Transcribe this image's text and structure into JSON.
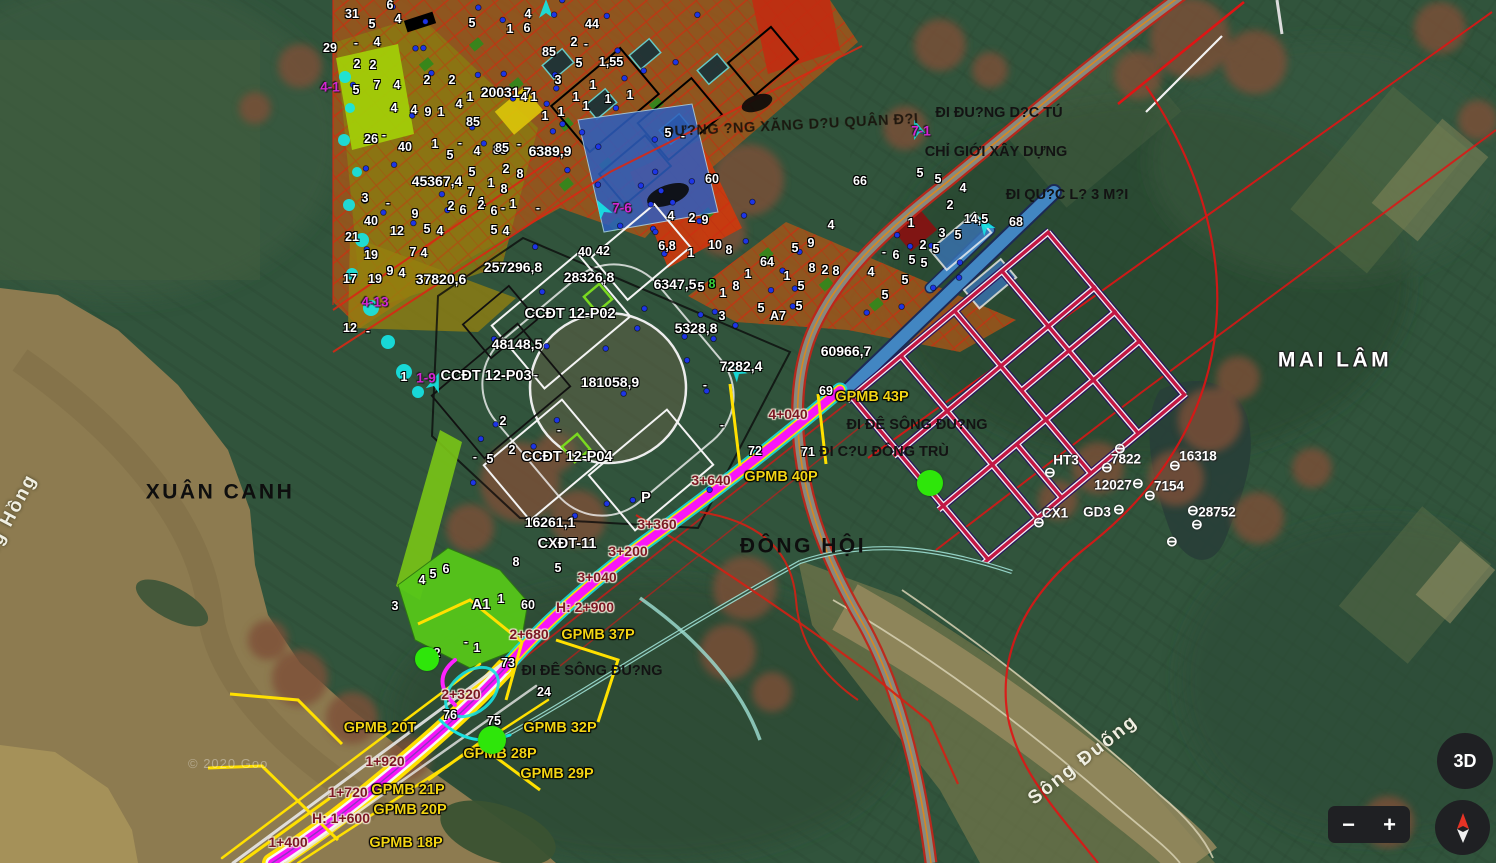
{
  "map": {
    "watermark": "© 2020 Goo",
    "place_labels": [
      {
        "text": "XUÂN CANH",
        "x": 220,
        "y": 492
      },
      {
        "text": "ĐÔNG HỘI",
        "x": 803,
        "y": 546
      },
      {
        "text": "MAI LÂM",
        "x": 1335,
        "y": 360,
        "variant": "halo"
      },
      {
        "text": "Sông Đuống",
        "x": 1083,
        "y": 760,
        "rotate": -38,
        "variant": "water"
      },
      {
        "text": "Sông Hồng",
        "x": 4,
        "y": 528,
        "rotate": -62,
        "variant": "water"
      }
    ],
    "road_labels": [
      {
        "text": "ĐI ĐU?NG D?C TÚ",
        "x": 999,
        "y": 113
      },
      {
        "text": "CHỈ GIỚI XÂY DỰNG",
        "x": 996,
        "y": 152
      },
      {
        "text": "ĐI QU?C L? 3 M?I",
        "x": 1067,
        "y": 195
      },
      {
        "text": "ĐƯ?NG ?NG XĂNG D?U QUÂN Đ?I",
        "x": 791,
        "y": 126,
        "rotate": -3,
        "variant": "pipeline"
      },
      {
        "text": "ĐI ĐÊ SÔNG ĐU?NG",
        "x": 917,
        "y": 425
      },
      {
        "text": "ĐI C?U ĐÔNG TRÙ",
        "x": 884,
        "y": 452
      },
      {
        "text": "ĐI ĐÊ SÔNG ĐU?NG",
        "x": 592,
        "y": 671
      }
    ],
    "area_labels": [
      {
        "text": "20031,7",
        "x": 506,
        "y": 92
      },
      {
        "text": "6389,9",
        "x": 550,
        "y": 151
      },
      {
        "text": "45367,4",
        "x": 437,
        "y": 181
      },
      {
        "text": "257296,8",
        "x": 513,
        "y": 267
      },
      {
        "text": "37820,6",
        "x": 441,
        "y": 279
      },
      {
        "text": "28326,8",
        "x": 589,
        "y": 277
      },
      {
        "text": "6347,5",
        "x": 675,
        "y": 284
      },
      {
        "text": "5328,8",
        "x": 696,
        "y": 328
      },
      {
        "text": "48148,5",
        "x": 517,
        "y": 344
      },
      {
        "text": "181058,9",
        "x": 610,
        "y": 382
      },
      {
        "text": "7282,4",
        "x": 741,
        "y": 366
      },
      {
        "text": "60966,7",
        "x": 846,
        "y": 351
      },
      {
        "text": "16261,1",
        "x": 550,
        "y": 522
      }
    ],
    "zone_labels": [
      {
        "text": "CCĐT 12-P02",
        "x": 570,
        "y": 314
      },
      {
        "text": "CCĐT 12-P03",
        "x": 486,
        "y": 376
      },
      {
        "text": "CCĐT 12-P04",
        "x": 567,
        "y": 457
      },
      {
        "text": "CXĐT-11",
        "x": 567,
        "y": 544
      },
      {
        "text": "A1",
        "x": 481,
        "y": 605
      },
      {
        "text": "P",
        "x": 646,
        "y": 498
      }
    ],
    "gpmb_labels": [
      {
        "text": "GPMB 43P",
        "x": 872,
        "y": 397
      },
      {
        "text": "GPMB 40P",
        "x": 781,
        "y": 477
      },
      {
        "text": "GPMB 37P",
        "x": 598,
        "y": 635
      },
      {
        "text": "GPMB 32P",
        "x": 560,
        "y": 728
      },
      {
        "text": "GPMB 28P",
        "x": 500,
        "y": 754
      },
      {
        "text": "GPMB 29P",
        "x": 557,
        "y": 774
      },
      {
        "text": "GPMB 20T",
        "x": 380,
        "y": 728
      },
      {
        "text": "GPMB 21P",
        "x": 408,
        "y": 790
      },
      {
        "text": "GPMB 20P",
        "x": 410,
        "y": 810
      },
      {
        "text": "GPMB 18P",
        "x": 406,
        "y": 843
      }
    ],
    "chainage_labels": [
      {
        "text": "4+040",
        "x": 788,
        "y": 414
      },
      {
        "text": "3+640",
        "x": 711,
        "y": 480
      },
      {
        "text": "3+360",
        "x": 657,
        "y": 524
      },
      {
        "text": "3+200",
        "x": 628,
        "y": 551
      },
      {
        "text": "3+040",
        "x": 597,
        "y": 577
      },
      {
        "text": "H: 2+900",
        "x": 585,
        "y": 607
      },
      {
        "text": "2+680",
        "x": 529,
        "y": 634
      },
      {
        "text": "2+320",
        "x": 461,
        "y": 694
      },
      {
        "text": "1+920",
        "x": 385,
        "y": 761
      },
      {
        "text": "1+720",
        "x": 348,
        "y": 792
      },
      {
        "text": "H: 1+600",
        "x": 341,
        "y": 818
      },
      {
        "text": "1+400",
        "x": 288,
        "y": 842
      }
    ],
    "route_marker_labels": [
      {
        "text": "4-1",
        "x": 330,
        "y": 87
      },
      {
        "text": "4-13",
        "x": 375,
        "y": 302
      },
      {
        "text": "1-9",
        "x": 426,
        "y": 378
      },
      {
        "text": "7-6",
        "x": 622,
        "y": 208
      },
      {
        "text": "7-1",
        "x": 921,
        "y": 131
      }
    ],
    "survey_markers": [
      {
        "text": "HT3",
        "x": 1066,
        "y": 460,
        "icon_dx": -16,
        "icon_dy": 12
      },
      {
        "text": "7822",
        "x": 1126,
        "y": 459,
        "icon_dx": -19,
        "icon_dy": 8
      },
      {
        "text": "16318",
        "x": 1198,
        "y": 456,
        "icon_dx": -23,
        "icon_dy": 9
      },
      {
        "text": "12027",
        "x": 1113,
        "y": 485,
        "icon_dx": 25,
        "icon_dy": -2
      },
      {
        "text": "7154",
        "x": 1169,
        "y": 486,
        "icon_dx": -19,
        "icon_dy": 9
      },
      {
        "text": "CX1",
        "x": 1055,
        "y": 513,
        "icon_dx": -16,
        "icon_dy": 9
      },
      {
        "text": "GD3",
        "x": 1097,
        "y": 512,
        "icon_dx": 22,
        "icon_dy": -3
      },
      {
        "text": "28752",
        "x": 1217,
        "y": 512,
        "icon_dx": -24,
        "icon_dy": -2
      }
    ],
    "extra_survey_icons": [
      [
        1120,
        448
      ],
      [
        1197,
        524
      ],
      [
        1172,
        541
      ]
    ],
    "green_dots": [
      {
        "x": 930,
        "y": 483,
        "r": 13
      },
      {
        "x": 492,
        "y": 740,
        "r": 14
      },
      {
        "x": 427,
        "y": 659,
        "r": 12
      }
    ],
    "small_numbers": [
      [
        "31",
        352,
        14
      ],
      [
        "6",
        390,
        5
      ],
      [
        "4",
        398,
        19
      ],
      [
        "5",
        372,
        24
      ],
      [
        "29",
        330,
        48
      ],
      [
        "2",
        357,
        64
      ],
      [
        "2",
        373,
        65
      ],
      [
        "4",
        377,
        42
      ],
      [
        "-",
        356,
        43
      ],
      [
        "7",
        377,
        85
      ],
      [
        "4",
        397,
        85
      ],
      [
        "5",
        356,
        90
      ],
      [
        "4",
        394,
        108
      ],
      [
        "4",
        414,
        110
      ],
      [
        "9",
        428,
        112
      ],
      [
        "1",
        441,
        112
      ],
      [
        "2",
        427,
        80
      ],
      [
        "2",
        452,
        80
      ],
      [
        "4",
        459,
        104
      ],
      [
        "1",
        470,
        97
      ],
      [
        "26",
        371,
        139
      ],
      [
        "-",
        384,
        135
      ],
      [
        "40",
        405,
        147
      ],
      [
        "1",
        435,
        144
      ],
      [
        "-",
        460,
        143
      ],
      [
        "5",
        450,
        155
      ],
      [
        "4",
        477,
        151
      ],
      [
        "85",
        500,
        150
      ],
      [
        "5",
        472,
        172
      ],
      [
        "2",
        506,
        169
      ],
      [
        "8",
        520,
        174
      ],
      [
        "7",
        471,
        192
      ],
      [
        "1",
        491,
        183
      ],
      [
        "8",
        504,
        189
      ],
      [
        "3",
        365,
        198
      ],
      [
        "-",
        388,
        203
      ],
      [
        "40",
        371,
        221
      ],
      [
        "9",
        415,
        214
      ],
      [
        "2",
        451,
        206
      ],
      [
        "6",
        463,
        210
      ],
      [
        "1",
        482,
        202
      ],
      [
        "-",
        503,
        208
      ],
      [
        "1",
        513,
        204
      ],
      [
        "21",
        352,
        237
      ],
      [
        "12",
        397,
        231
      ],
      [
        "5",
        427,
        229
      ],
      [
        "4",
        440,
        231
      ],
      [
        "19",
        371,
        255
      ],
      [
        "7",
        413,
        252
      ],
      [
        "4",
        424,
        253
      ],
      [
        "17",
        350,
        279
      ],
      [
        "19",
        375,
        279
      ],
      [
        "9",
        390,
        271
      ],
      [
        "4",
        402,
        273
      ],
      [
        "12",
        350,
        328
      ],
      [
        "-",
        368,
        331
      ],
      [
        "1",
        404,
        377
      ],
      [
        "5",
        472,
        23
      ],
      [
        "4",
        528,
        14
      ],
      [
        "1",
        510,
        29
      ],
      [
        "6",
        527,
        28
      ],
      [
        "85",
        549,
        52
      ],
      [
        "2",
        574,
        42
      ],
      [
        "-",
        586,
        44
      ],
      [
        "5",
        579,
        63
      ],
      [
        "1,55",
        611,
        62
      ],
      [
        "3",
        558,
        80
      ],
      [
        "1",
        593,
        85
      ],
      [
        "1",
        576,
        97
      ],
      [
        "1",
        608,
        99
      ],
      [
        "1",
        586,
        106
      ],
      [
        "1",
        630,
        95
      ],
      [
        "44",
        592,
        24
      ],
      [
        "85",
        473,
        122
      ],
      [
        "4",
        524,
        97
      ],
      [
        "1",
        534,
        97
      ],
      [
        "85",
        502,
        148
      ],
      [
        "-",
        519,
        144
      ],
      [
        "1",
        545,
        116
      ],
      [
        "1",
        561,
        112
      ],
      [
        "2",
        481,
        205
      ],
      [
        "6",
        494,
        211
      ],
      [
        "-",
        538,
        208
      ],
      [
        "5",
        494,
        230
      ],
      [
        "4",
        506,
        231
      ],
      [
        "5",
        668,
        133
      ],
      [
        "-",
        683,
        136
      ],
      [
        "60",
        712,
        179
      ],
      [
        "4",
        671,
        216
      ],
      [
        "2",
        692,
        218
      ],
      [
        "9",
        705,
        220
      ],
      [
        "6,8",
        667,
        246
      ],
      [
        "1",
        691,
        253
      ],
      [
        "10",
        715,
        245
      ],
      [
        "8",
        729,
        250
      ],
      [
        "64",
        767,
        262
      ],
      [
        "5",
        701,
        287
      ],
      [
        "8",
        712,
        284,
        "#39d23c"
      ],
      [
        "8",
        736,
        286
      ],
      [
        "1",
        748,
        274
      ],
      [
        "1",
        723,
        293
      ],
      [
        "5",
        795,
        248
      ],
      [
        "1",
        787,
        276
      ],
      [
        "5",
        801,
        286
      ],
      [
        "5",
        799,
        306
      ],
      [
        "3",
        722,
        316
      ],
      [
        "5",
        761,
        308
      ],
      [
        "A7",
        778,
        316
      ],
      [
        "66",
        860,
        181
      ],
      [
        "5",
        920,
        173
      ],
      [
        "5",
        938,
        179
      ],
      [
        "4",
        963,
        188
      ],
      [
        "2",
        950,
        205
      ],
      [
        "1",
        911,
        223
      ],
      [
        "14,5",
        976,
        219
      ],
      [
        "3",
        942,
        233
      ],
      [
        "5",
        958,
        235
      ],
      [
        "68",
        1016,
        222
      ],
      [
        "2",
        923,
        245
      ],
      [
        "5",
        936,
        249
      ],
      [
        "-",
        884,
        252
      ],
      [
        "6",
        896,
        255
      ],
      [
        "5",
        912,
        260
      ],
      [
        "5",
        924,
        263
      ],
      [
        "4",
        871,
        272
      ],
      [
        "5",
        905,
        280
      ],
      [
        "5",
        885,
        295
      ],
      [
        "8",
        812,
        268
      ],
      [
        "2",
        825,
        270
      ],
      [
        "8",
        836,
        271
      ],
      [
        "9",
        811,
        243
      ],
      [
        "4",
        831,
        225
      ],
      [
        "40",
        585,
        252
      ],
      [
        "42",
        603,
        251
      ],
      [
        "2",
        503,
        421
      ],
      [
        "2",
        512,
        450
      ],
      [
        "5",
        490,
        459
      ],
      [
        "-",
        475,
        457
      ],
      [
        "-",
        536,
        375
      ],
      [
        "-",
        559,
        430
      ],
      [
        "-",
        705,
        385
      ],
      [
        "-",
        722,
        425
      ],
      [
        "69",
        826,
        391
      ],
      [
        "72",
        755,
        451
      ],
      [
        "71",
        808,
        452
      ],
      [
        "8",
        516,
        562
      ],
      [
        "5",
        558,
        568
      ],
      [
        "4",
        422,
        580
      ],
      [
        "5",
        433,
        574
      ],
      [
        "6",
        446,
        569
      ],
      [
        "3",
        395,
        606
      ],
      [
        "1",
        501,
        599
      ],
      [
        "60",
        528,
        605
      ],
      [
        "-",
        466,
        642
      ],
      [
        "1",
        477,
        648
      ],
      [
        "2",
        437,
        653
      ],
      [
        "73",
        508,
        663
      ],
      [
        "24",
        544,
        692
      ],
      [
        "76",
        450,
        715
      ],
      [
        "75",
        494,
        721
      ]
    ]
  },
  "controls": {
    "three_d": "3D",
    "zoom_out": "−",
    "zoom_in": "+"
  }
}
